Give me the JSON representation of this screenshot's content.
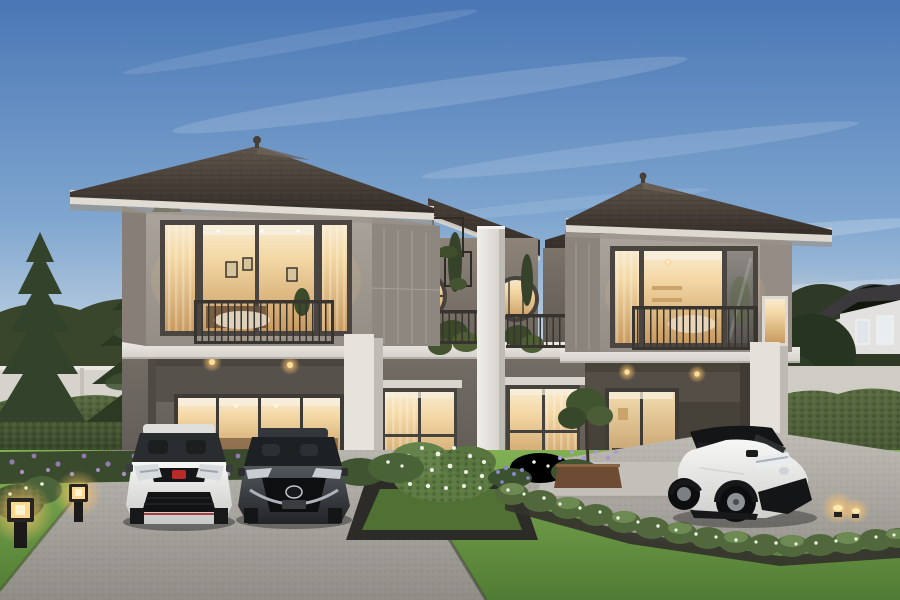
{
  "meta": {
    "type": "architectural-rendering",
    "time_of_day": "dusk",
    "description": "Twilight exterior rendering of a modern two-story twin home with a central white divider fin, planted terrace with two round windows, left carport holding a white hatchback and a dark sedan, a white SUV with black roof on the right driveway, manicured lawn, hedges, flower beds and glowing garden lanterns"
  },
  "palette": {
    "sky_top": "#4a77b5",
    "sky_mid": "#7fa6cf",
    "sky_low": "#bccee0",
    "sky_horizon": "#e8d2ba",
    "haze_warm": "#f4ddc0",
    "cloud_white": "#ffffff",
    "roof_light": "#60564b",
    "roof_dark": "#362f2a",
    "roof_ridge": "#6d6257",
    "center_roof_light": "#4a4138",
    "center_roof_dark": "#332d28",
    "soffit_white": "#e0dbd3",
    "fascia_shadow": "#9a948c",
    "wall_upper_light": "#aaa39b",
    "wall_upper_dark": "#948d85",
    "wall_side": "#8e877f",
    "wall_lower_light": "#746e67",
    "wall_lower_dark": "#5a5550",
    "recess_dark": "#474239",
    "trim_white": "#e6e3dd",
    "trim_shade": "#bfbbb5",
    "band_light": "#ece9e4",
    "band_dark": "#d3cfc9",
    "fin_light": "#f0eee9",
    "fin_dark": "#d8d4ce",
    "frame_dark": "#4a4540",
    "railing_dark": "#37332e",
    "glow_pale": "#f8ead0",
    "glow_warm": "#f4d9a6",
    "glow_deep": "#c89a60",
    "door_glow_top": "#f2dcae",
    "door_glow_bottom": "#b98d58",
    "lamp_warm": "#ffd891",
    "lamp_halo": "#ffc46a",
    "glass_cool_light": "#8d8a84",
    "glass_cool_dark": "#57554f",
    "terrace_wall_light": "#8d8379",
    "terrace_wall_dark": "#6e675f",
    "lawn_light": "#82b054",
    "lawn_dark": "#507b34",
    "hedge_light": "#5a6c42",
    "hedge_dark": "#2e3a23",
    "conifer_dark": "#2c3a24",
    "conifer_mid": "#3e5130",
    "foliage_bg": "#39462c",
    "foliage_right": "#2e3a25",
    "flower_purple": "#9379b0",
    "flower_purple_light": "#a78fc2",
    "flower_white": "#eef2e4",
    "flower_blue": "#8b87cc",
    "drive_light": "#b9b6b0",
    "drive_dark": "#908d87",
    "drive_right_light": "#c0bdb7",
    "drive_right_dark": "#999690",
    "paver_dark": "#34322d",
    "platform_gray": "#c3c0ba",
    "planter_wood": "#6e4c34",
    "soil_dark": "#2d2b27",
    "bed_green": "#517134",
    "wall_white": "#d6d3cd",
    "neighbor_wall": "#e2e1df",
    "neighbor_roof": "#3b393b",
    "car_white_top": "#f6f6f4",
    "car_white_bottom": "#c9cac8",
    "car_dark_top": "#53575c",
    "car_dark_bottom": "#222427",
    "suv_white_top": "#f7f7f5",
    "suv_white_bottom": "#cfd0ce",
    "suv_black": "#141516",
    "badge_red": "#b92b28",
    "chrome": "#aeb3b9",
    "tire_black": "#0c0d0e",
    "glass_tint": "#2a2d30"
  },
  "scene": {
    "setting": "dusk exterior rendering of a residential twin house",
    "house": {
      "floors": 2,
      "wings": 2,
      "roof": "hip roof, dark grey-brown tile, white soffits",
      "upper_wall": "warm taupe panels",
      "lower_wall": "dark grey",
      "center_divider": "tall white vertical fin wall",
      "round_windows": 2,
      "balconies": [
        "left wing upper balcony",
        "right wing upper balcony"
      ],
      "terrace": "central planted terrace with dark railings"
    },
    "vehicles": [
      {
        "id": "white-hatchback",
        "description": "white sport hatchback, front view, red brand badge, black grille",
        "position": "left carport"
      },
      {
        "id": "dark-sedan",
        "description": "dark grey sedan, front view, chrome grille wing",
        "position": "left carport"
      },
      {
        "id": "white-suv",
        "description": "white compact SUV with black roof, three-quarter view",
        "position": "right driveway"
      }
    ],
    "landscaping": [
      "tall conifer trees on left",
      "clipped hedge walls",
      "purple flower bed",
      "white flowering shrubs",
      "square planter bed with dark border",
      "bright lawn",
      "aggregate concrete driveways",
      "wooden planter with blue flowers"
    ],
    "lighting": [
      "warm interior glow in all windows",
      "four recessed carport downlights",
      "two cube garden lanterns on left lawn",
      "two accent lights at right hedge"
    ],
    "background": [
      "neighboring white house upper right",
      "dense background trees",
      "white boundary walls"
    ]
  }
}
